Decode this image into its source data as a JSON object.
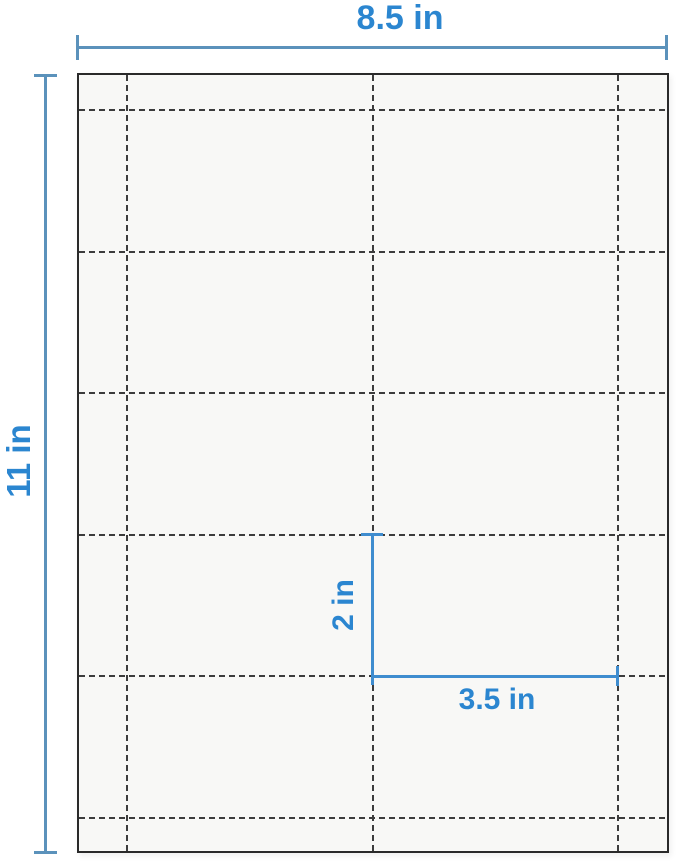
{
  "diagram": {
    "description": "Perforated sheet dimension diagram",
    "sheet": {
      "rows": 5,
      "columns": 2,
      "cut_line_style": "dashed"
    },
    "labels": {
      "sheet_width": "8.5 in",
      "sheet_height": "11 in",
      "card_height": "2 in",
      "card_width": "3.5 in"
    },
    "colors": {
      "accent_text": "#2b86d0",
      "dimension_line": "#5b92bb",
      "card_dimension_line": "#3f8dcf",
      "cut_line": "#3c3c3c",
      "paper_fill": "#f8f8f6",
      "paper_border": "#2a2a2a",
      "background": "#ffffff"
    }
  }
}
